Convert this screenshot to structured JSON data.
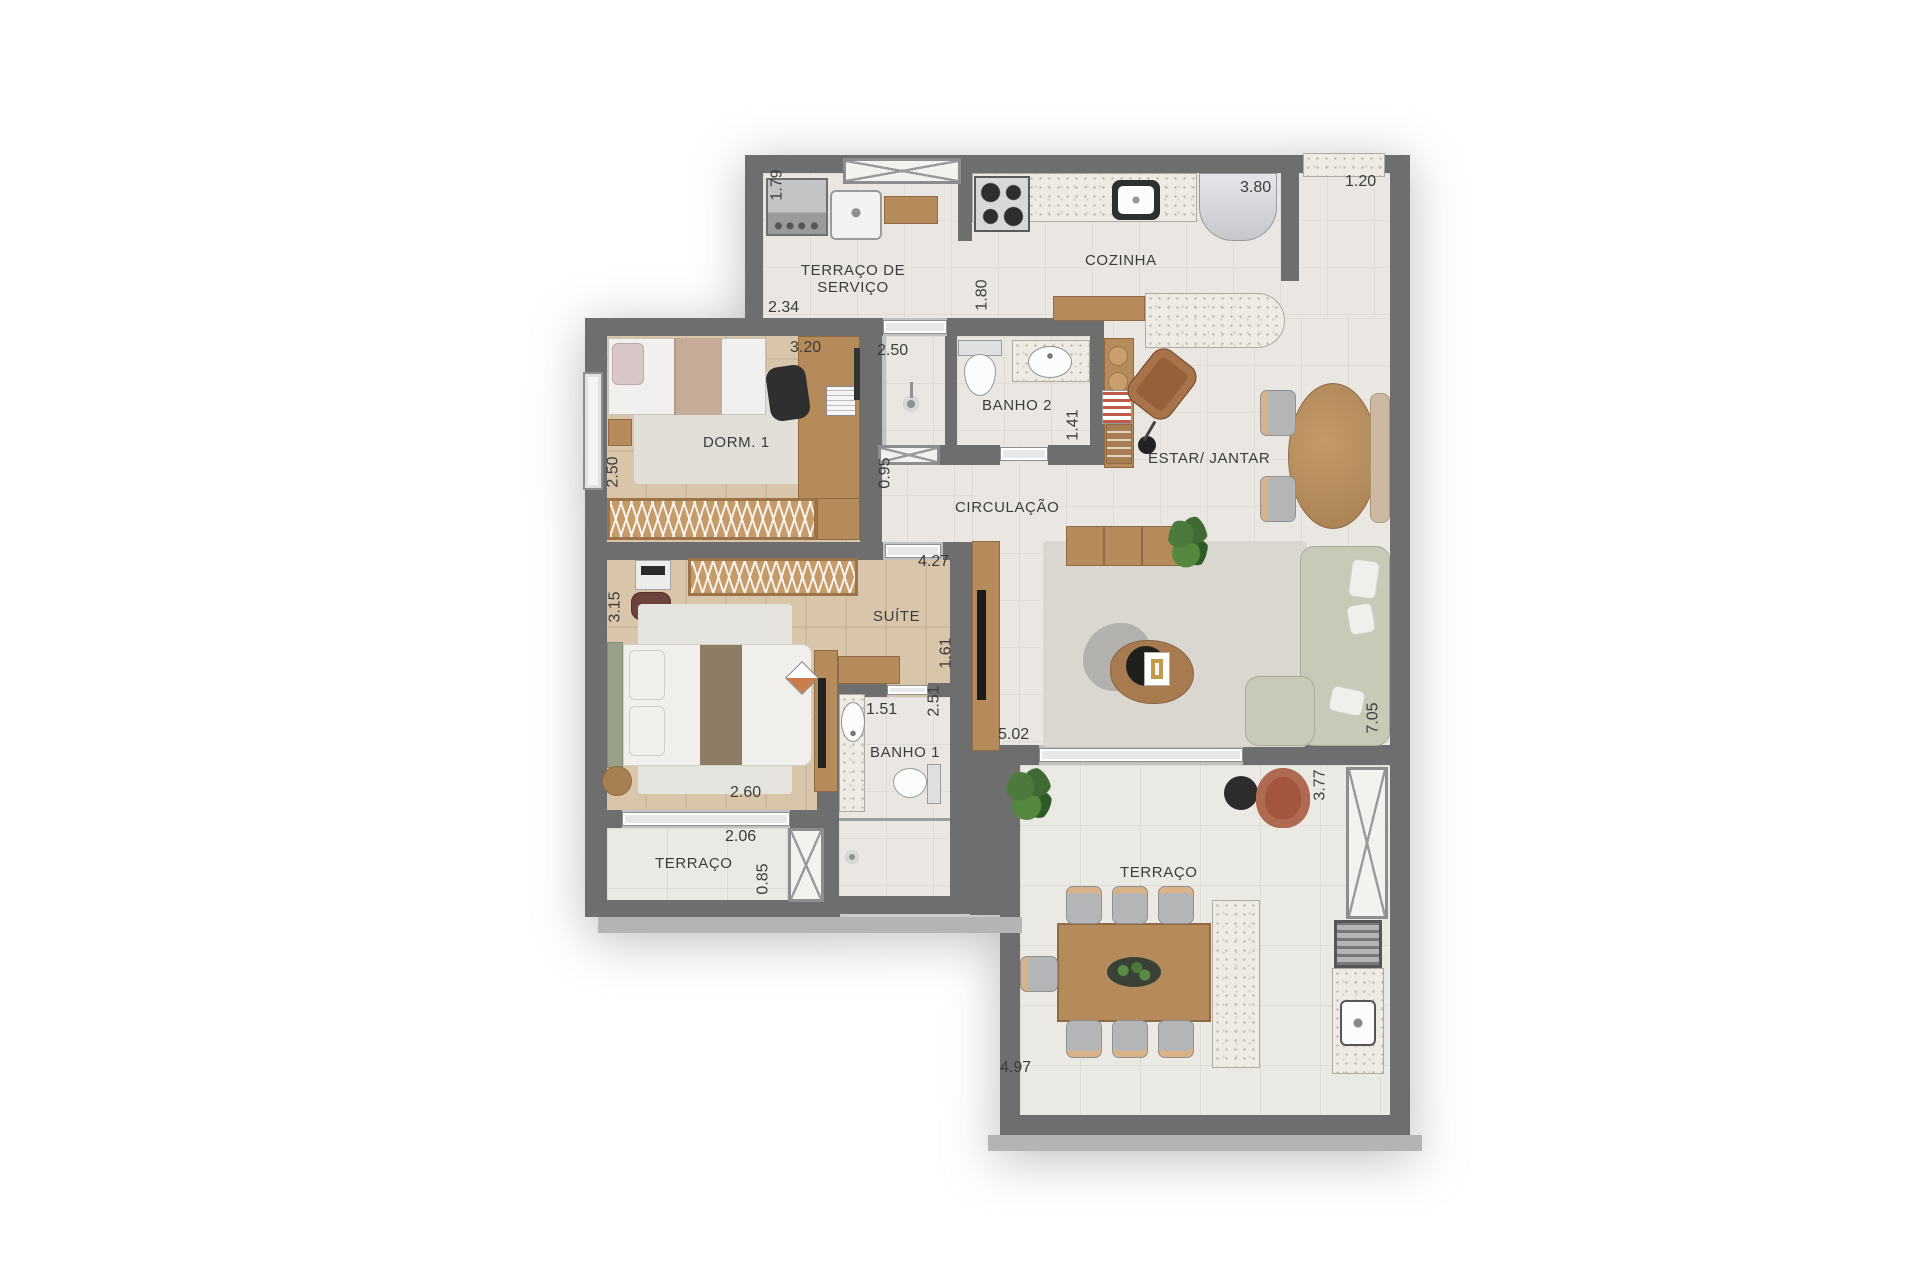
{
  "title": "Planta do apartamento",
  "rooms": {
    "terraco_servico": "TERRAÇO DE SERVIÇO",
    "cozinha": "COZINHA",
    "dorm1": "DORM. 1",
    "banho2": "BANHO 2",
    "circulacao": "CIRCULAÇÃO",
    "estar_jantar": "ESTAR/ JANTAR",
    "suite": "SUÍTE",
    "banho1": "BANHO 1",
    "terraco_esq": "TERRAÇO",
    "terraco_fundo": "TERRAÇO"
  },
  "dims": {
    "v1_79": "1.79",
    "v2_34": "2.34",
    "v3_80": "3.80",
    "v1_20": "1.20",
    "v1_80": "1.80",
    "v3_20": "3.20",
    "v2_50_dorm": "2.50",
    "v2_50_banho": "2.50",
    "v1_41": "1.41",
    "v0_95": "0.95",
    "v4_27": "4.27",
    "v1_61": "1.61",
    "v3_15": "3.15",
    "v1_51": "1.51",
    "v2_51": "2.51",
    "v2_60": "2.60",
    "v2_06": "2.06",
    "v0_85": "0.85",
    "v5_02": "5.02",
    "v7_05": "7.05",
    "v3_77": "3.77",
    "v4_97": "4.97"
  },
  "palette": {
    "wall": "#6e6e6e",
    "tile_floor": "#eae7e2",
    "wood_floor": "#d9c5a9",
    "wood_furniture": "#b68b5c",
    "granite": "#eeebe4",
    "sofa": "#c9c9b7",
    "armchair_rust": "#a4553d",
    "label_text": "#3c3c3c"
  }
}
